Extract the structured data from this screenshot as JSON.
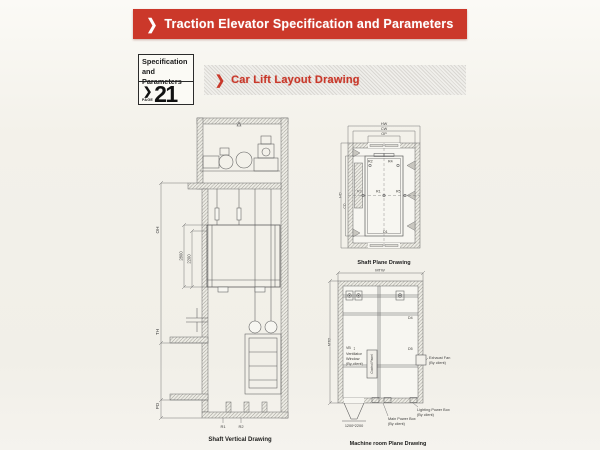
{
  "header": {
    "chevron": "❯",
    "title": "Traction Elevator Specification and Parameters"
  },
  "page_tab": {
    "line1": "Specification",
    "line2": "and Parameters",
    "chevron": "❯",
    "page_label": "PAGE",
    "page_number": "21"
  },
  "section": {
    "chevron": "❯",
    "title": "Car Lift Layout Drawing"
  },
  "colors": {
    "banner_red": "#cb382a",
    "paper": "#f3f1ea",
    "ink": "#5c5c5c"
  },
  "shaft_vertical": {
    "caption": "Shaft Vertical Drawing",
    "dim_oh": "OH",
    "dim_th": "TH",
    "dim_pd": "PD",
    "dim_2800": "2800",
    "dim_2200": "2200",
    "label_r1": "R1",
    "label_r2": "R2"
  },
  "shaft_plane": {
    "caption": "Shaft Plane Drawing",
    "dim_hw": "HW",
    "dim_cw": "CW",
    "dim_op": "OP",
    "dim_hd": "HD",
    "dim_cd": "CD",
    "label_r1": "R1",
    "label_r2": "R2",
    "label_r3": "R3",
    "label_r4": "R4",
    "label_r5": "R5",
    "label_d1": "D1"
  },
  "machine_room": {
    "caption": "Machine room Plane Drawing",
    "dim_mtw": "MTW",
    "dim_mtd": "MTD",
    "vb": "VB",
    "updown_arrow": "↕",
    "ventilator_l1": "Ventilator",
    "ventilator_l2": "Window",
    "ventilator_l3": "(By client)",
    "control_panel": "Control Panel",
    "exhaust_l1": "Exhaust Fan",
    "exhaust_l2": "(By client)",
    "main_power_l1": "Main Power Box",
    "main_power_l2": "(By client)",
    "lighting_l1": "Lighting Power Box",
    "lighting_l2": "(By client)",
    "door_size": "1200*2200",
    "label_d4": "D4",
    "label_d5": "D5"
  }
}
